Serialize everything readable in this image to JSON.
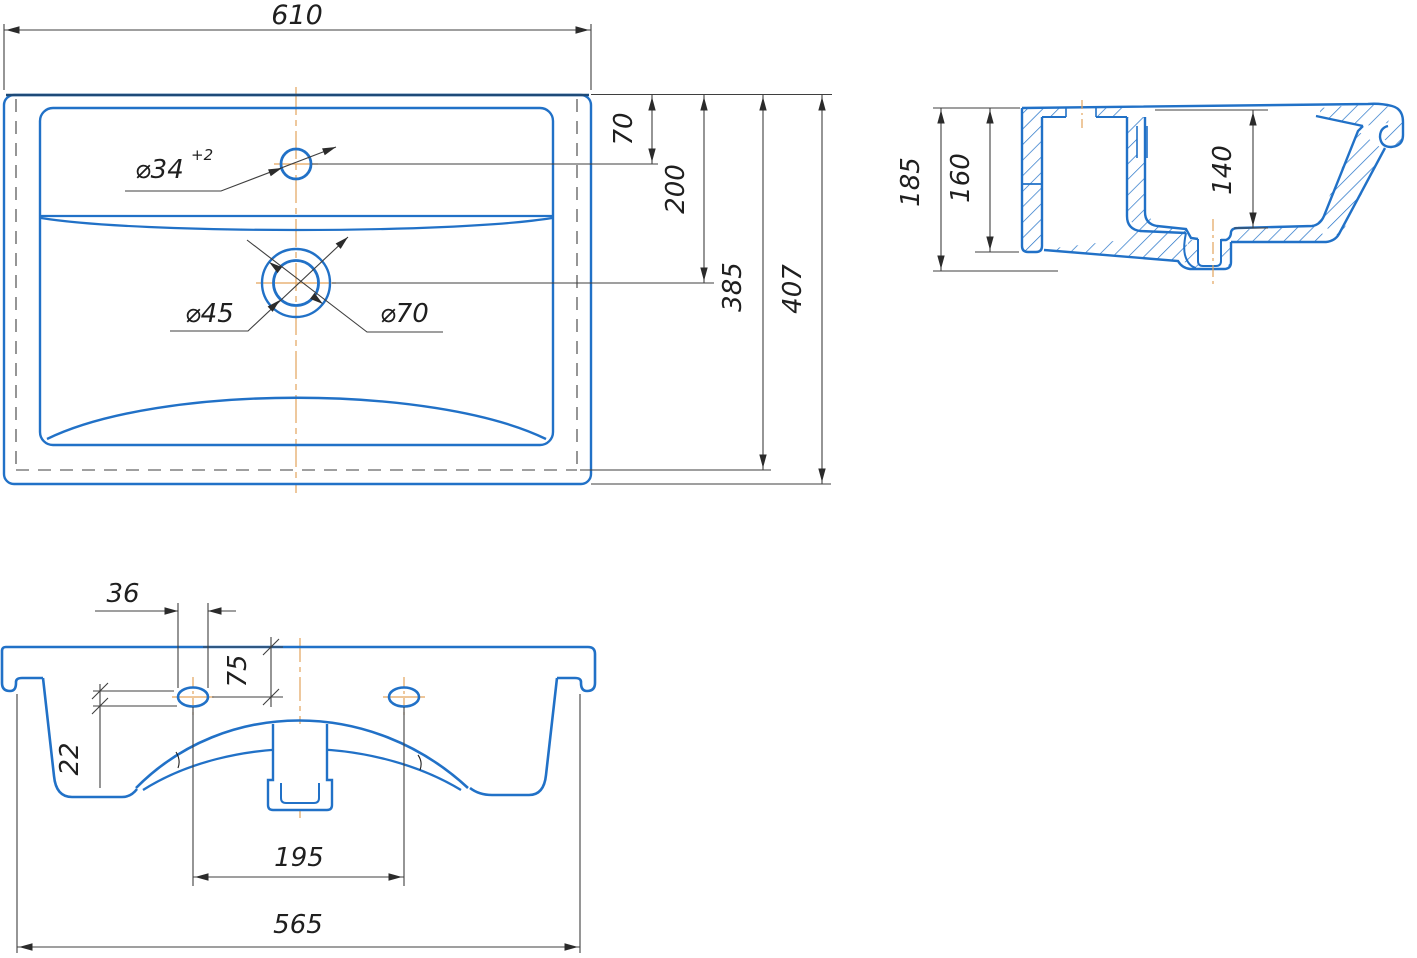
{
  "drawing": {
    "title": "washbasin-technical-drawing",
    "top_view": {
      "overall_width": "610",
      "faucet_hole_offset": "70",
      "drain_offset": "200",
      "inner_depth": "385",
      "overall_depth": "407",
      "faucet_hole_dia": "⌀34",
      "faucet_hole_tolerance": "+2",
      "drain_inner_dia": "⌀45",
      "drain_outer_dia": "⌀70"
    },
    "section_view": {
      "overall_height": "185",
      "back_wall_height": "160",
      "bowl_depth": "140"
    },
    "front_view": {
      "mount_hole_width": "36",
      "rim_to_hole_center": "75",
      "mount_hole_height": "22",
      "mount_hole_spacing": "195",
      "body_width": "565"
    },
    "colors": {
      "outline_blue": "#2171c7",
      "centerline_orange": "#e3a45c",
      "dimension_gray": "#3f3f3f"
    }
  }
}
